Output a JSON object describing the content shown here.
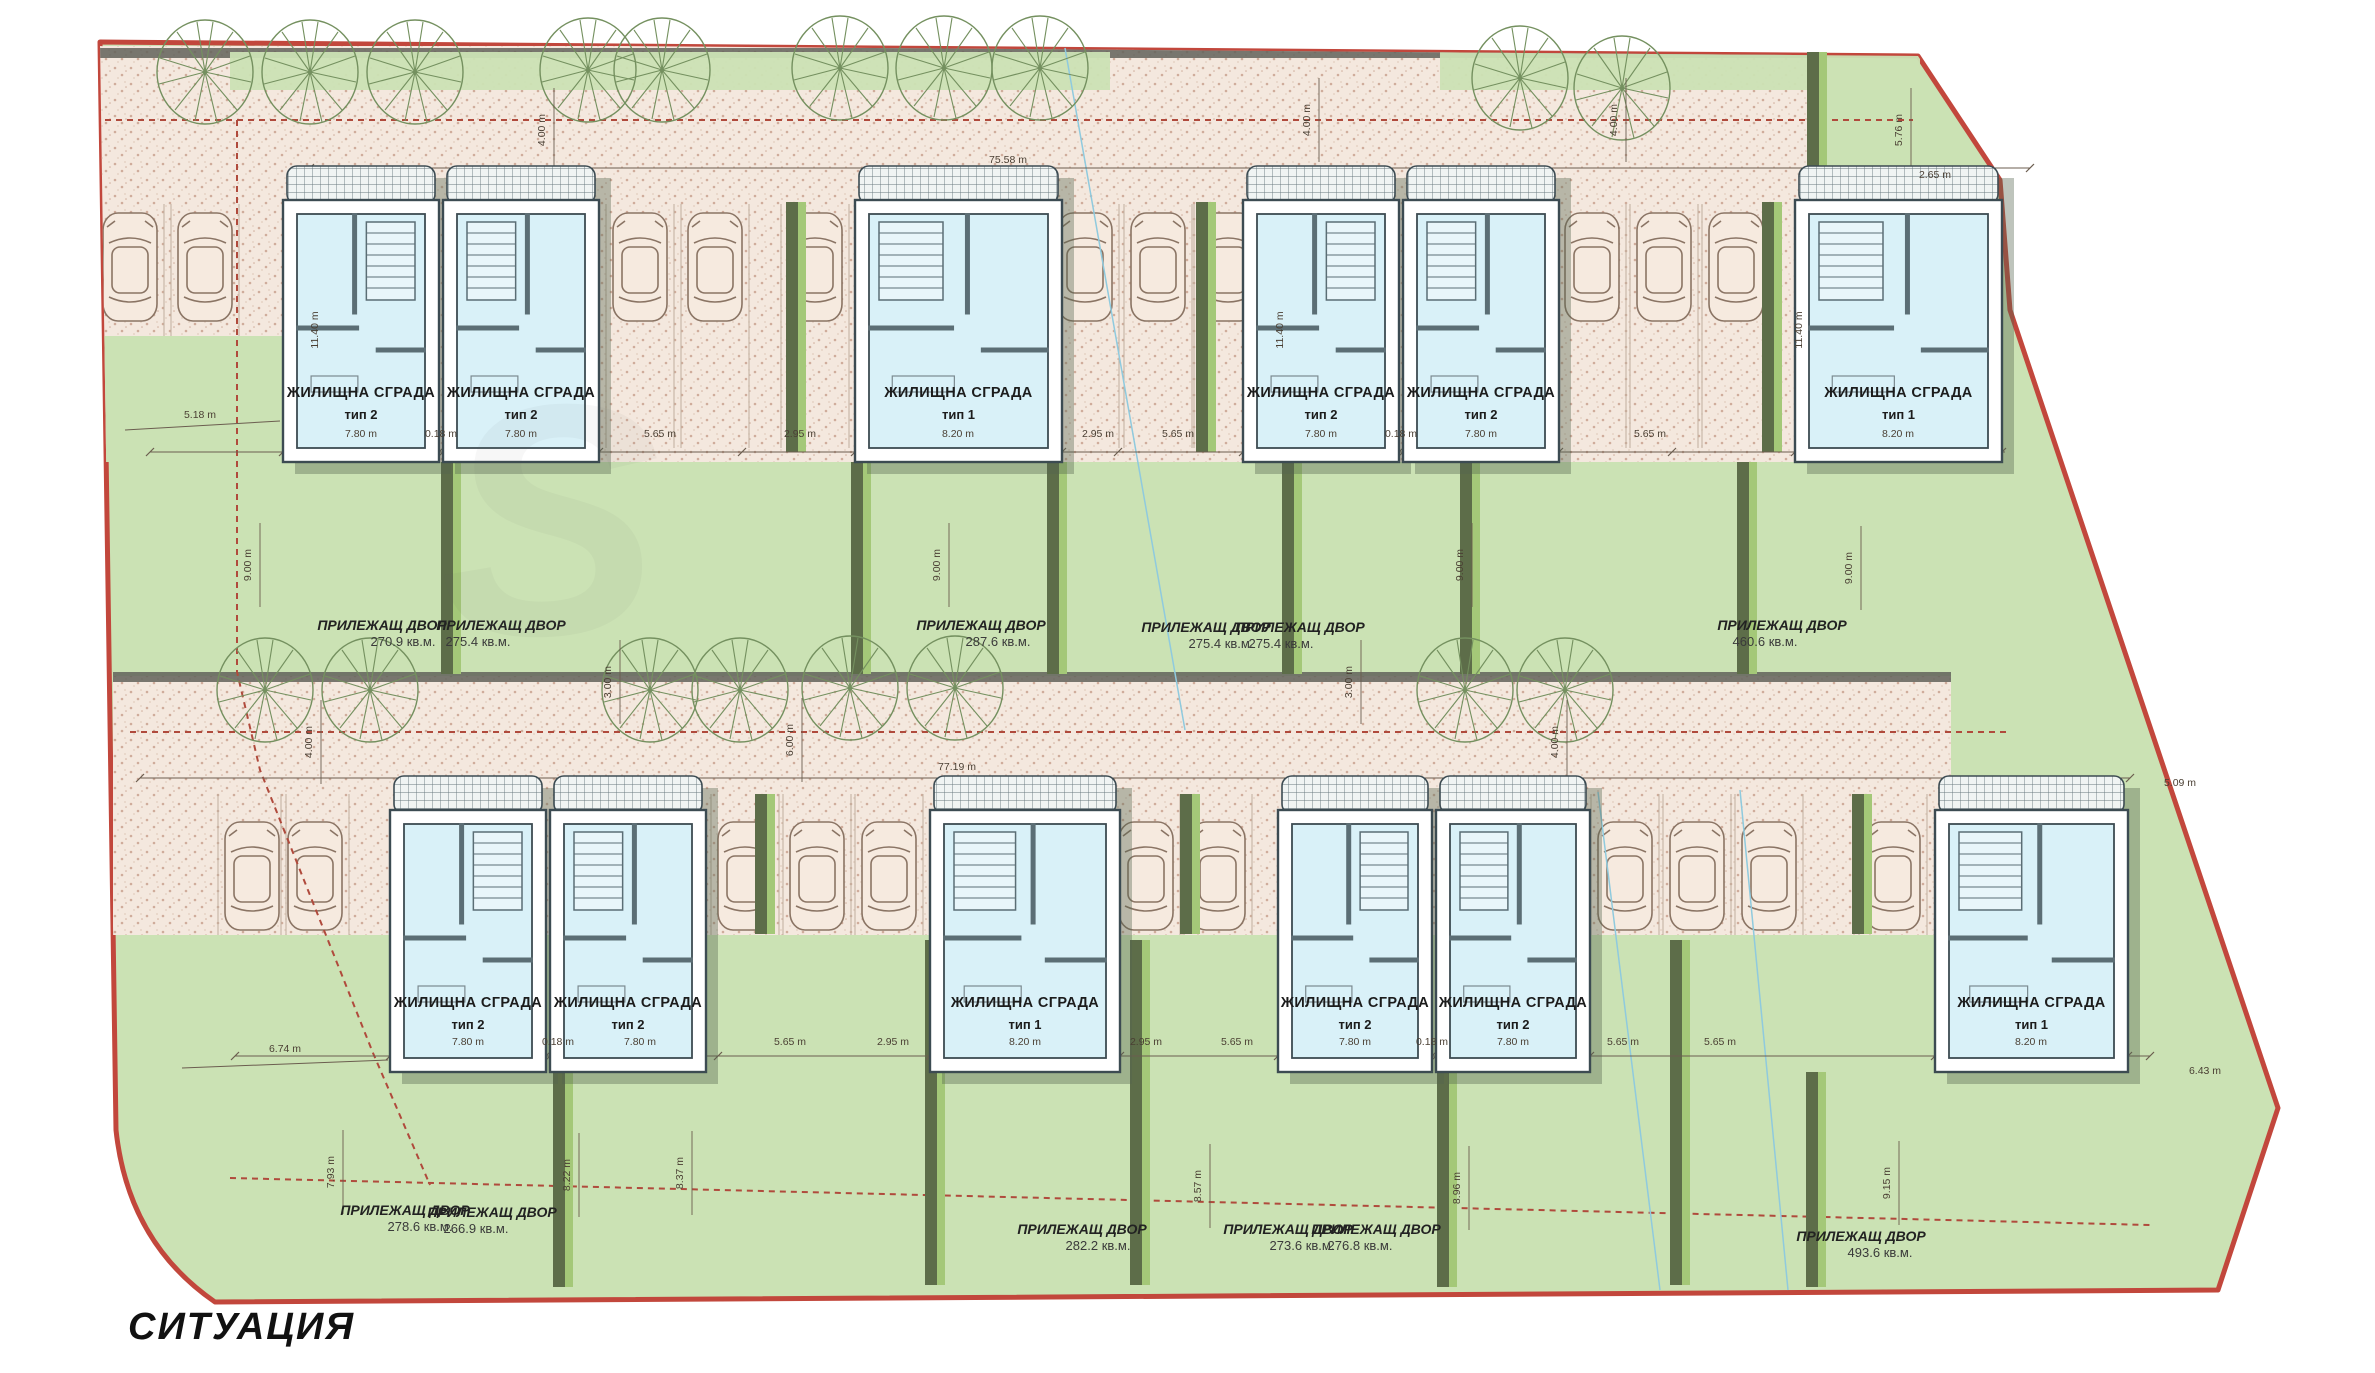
{
  "title": "СИТУАЦИЯ",
  "watermark": "S",
  "colors": {
    "boundary": "#c2473c",
    "parcel_dash": "#b04a3c",
    "site_green": "#cbe2b4",
    "road_pink": "#f4e8de",
    "road_dot": "#c9a28f",
    "curb": "#62625a",
    "fence_dark": "#5d6d49",
    "fence_light": "#a4c878",
    "wall_outline": "#3c4b52",
    "wall_fill": "#ffffff",
    "interior": "#d9f1f8",
    "interior_wall": "#5b6e75",
    "shadow": "#55654f",
    "tree": "#74905f",
    "car": "#8a7464",
    "dim": "#4a3f33",
    "terrace_bg": "#f0f4f3",
    "terrace_line": "#68787e",
    "utility_blue": "#8fcade"
  },
  "buildings": [
    {
      "name": "ЖИЛИЩНА СГРАДА",
      "type": "тип 2",
      "row": "top",
      "x": 283,
      "w": 156,
      "stair": "right"
    },
    {
      "name": "ЖИЛИЩНА СГРАДА",
      "type": "тип 2",
      "row": "top",
      "x": 443,
      "w": 156,
      "stair": "left"
    },
    {
      "name": "ЖИЛИЩНА СГРАДА",
      "type": "тип 1",
      "row": "top",
      "x": 855,
      "w": 207,
      "stair": "left"
    },
    {
      "name": "ЖИЛИЩНА СГРАДА",
      "type": "тип 2",
      "row": "top",
      "x": 1243,
      "w": 156,
      "stair": "right"
    },
    {
      "name": "ЖИЛИЩНА СГРАДА",
      "type": "тип 2",
      "row": "top",
      "x": 1403,
      "w": 156,
      "stair": "left"
    },
    {
      "name": "ЖИЛИЩНА СГРАДА",
      "type": "тип 1",
      "row": "top",
      "x": 1795,
      "w": 207,
      "stair": "left"
    },
    {
      "name": "ЖИЛИЩНА СГРАДА",
      "type": "тип 2",
      "row": "bottom",
      "x": 390,
      "w": 156,
      "stair": "right"
    },
    {
      "name": "ЖИЛИЩНА СГРАДА",
      "type": "тип 2",
      "row": "bottom",
      "x": 550,
      "w": 156,
      "stair": "left"
    },
    {
      "name": "ЖИЛИЩНА СГРАДА",
      "type": "тип 1",
      "row": "bottom",
      "x": 930,
      "w": 190,
      "stair": "left"
    },
    {
      "name": "ЖИЛИЩНА СГРАДА",
      "type": "тип 2",
      "row": "bottom",
      "x": 1278,
      "w": 154,
      "stair": "right"
    },
    {
      "name": "ЖИЛИЩНА СГРАДА",
      "type": "тип 2",
      "row": "bottom",
      "x": 1436,
      "w": 154,
      "stair": "left"
    },
    {
      "name": "ЖИЛИЩНА СГРАДА",
      "type": "тип 1",
      "row": "bottom",
      "x": 1935,
      "w": 193,
      "stair": "left"
    }
  ],
  "yards": [
    {
      "name": "ПРИЛЕЖАЩ ДВОР",
      "area": "270.9 кв.м.",
      "nx": 382,
      "ny": 630,
      "ax": 403,
      "ay": 646
    },
    {
      "name": "ПРИЛЕЖАЩ ДВОР",
      "area": "275.4 кв.м.",
      "nx": 501,
      "ny": 630,
      "ax": 478,
      "ay": 646
    },
    {
      "name": "ПРИЛЕЖАЩ ДВОР",
      "area": "287.6 кв.м.",
      "nx": 981,
      "ny": 630,
      "ax": 998,
      "ay": 646
    },
    {
      "name": "ПРИЛЕЖАЩ ДВОР",
      "area": "275.4 кв.м.",
      "nx": 1206,
      "ny": 632,
      "ax": 1221,
      "ay": 648
    },
    {
      "name": "ПРИЛЕЖАЩ ДВОР",
      "area": "275.4 кв.м.",
      "nx": 1300,
      "ny": 632,
      "ax": 1281,
      "ay": 648
    },
    {
      "name": "ПРИЛЕЖАЩ ДВОР",
      "area": "460.6 кв.м.",
      "nx": 1782,
      "ny": 630,
      "ax": 1765,
      "ay": 646
    },
    {
      "name": "ПРИЛЕЖАЩ ДВОР",
      "area": "278.6 кв.м.",
      "nx": 405,
      "ny": 1215,
      "ax": 420,
      "ay": 1231
    },
    {
      "name": "ПРИЛЕЖАЩ ДВОР",
      "area": "266.9 кв.м.",
      "nx": 492,
      "ny": 1217,
      "ax": 476,
      "ay": 1233
    },
    {
      "name": "ПРИЛЕЖАЩ ДВОР",
      "area": "282.2 кв.м.",
      "nx": 1082,
      "ny": 1234,
      "ax": 1098,
      "ay": 1250
    },
    {
      "name": "ПРИЛЕЖАЩ ДВОР",
      "area": "273.6 кв.м.",
      "nx": 1288,
      "ny": 1234,
      "ax": 1302,
      "ay": 1250
    },
    {
      "name": "ПРИЛЕЖАЩ ДВОР",
      "area": "276.8 кв.м.",
      "nx": 1376,
      "ny": 1234,
      "ax": 1360,
      "ay": 1250
    },
    {
      "name": "ПРИЛЕЖАЩ ДВОР",
      "area": "493.6 кв.м.",
      "nx": 1861,
      "ny": 1241,
      "ax": 1880,
      "ay": 1257
    }
  ],
  "dimensions": [
    {
      "t": "75.58 m",
      "x": 1008,
      "y": 163,
      "r": 0
    },
    {
      "t": "77.19 m",
      "x": 957,
      "y": 770,
      "r": 0
    },
    {
      "t": "4.00 m",
      "x": 545,
      "y": 130,
      "r": -90
    },
    {
      "t": "4.00 m",
      "x": 1310,
      "y": 120,
      "r": -90
    },
    {
      "t": "4.00 m",
      "x": 1617,
      "y": 120,
      "r": -90
    },
    {
      "t": "5.76 m",
      "x": 1902,
      "y": 130,
      "r": -90
    },
    {
      "t": "2.65 m",
      "x": 1935,
      "y": 178,
      "r": 0
    },
    {
      "t": "5.18 m",
      "x": 200,
      "y": 418,
      "r": 0
    },
    {
      "t": "7.80 m",
      "x": 361,
      "y": 437,
      "r": 0
    },
    {
      "t": "0.18 m",
      "x": 441,
      "y": 437,
      "r": 0
    },
    {
      "t": "7.80 m",
      "x": 521,
      "y": 437,
      "r": 0
    },
    {
      "t": "5.65 m",
      "x": 660,
      "y": 437,
      "r": 0
    },
    {
      "t": "2.95 m",
      "x": 800,
      "y": 437,
      "r": 0
    },
    {
      "t": "8.20 m",
      "x": 958,
      "y": 437,
      "r": 0
    },
    {
      "t": "2.95 m",
      "x": 1098,
      "y": 437,
      "r": 0
    },
    {
      "t": "5.65 m",
      "x": 1178,
      "y": 437,
      "r": 0
    },
    {
      "t": "7.80 m",
      "x": 1321,
      "y": 437,
      "r": 0
    },
    {
      "t": "0.18 m",
      "x": 1401,
      "y": 437,
      "r": 0
    },
    {
      "t": "7.80 m",
      "x": 1481,
      "y": 437,
      "r": 0
    },
    {
      "t": "5.65 m",
      "x": 1650,
      "y": 437,
      "r": 0
    },
    {
      "t": "8.20 m",
      "x": 1898,
      "y": 437,
      "r": 0
    },
    {
      "t": "9.00 m",
      "x": 251,
      "y": 565,
      "r": -90
    },
    {
      "t": "9.00 m",
      "x": 940,
      "y": 565,
      "r": -90
    },
    {
      "t": "9.00 m",
      "x": 1463,
      "y": 565,
      "r": -90
    },
    {
      "t": "9.00 m",
      "x": 1852,
      "y": 568,
      "r": -90
    },
    {
      "t": "11.40 m",
      "x": 318,
      "y": 330,
      "r": -90
    },
    {
      "t": "11.40 m",
      "x": 1283,
      "y": 330,
      "r": -90
    },
    {
      "t": "11.40 m",
      "x": 1802,
      "y": 330,
      "r": -90
    },
    {
      "t": "3.00 m",
      "x": 611,
      "y": 682,
      "r": -90
    },
    {
      "t": "3.00 m",
      "x": 1352,
      "y": 682,
      "r": -90
    },
    {
      "t": "4.00 m",
      "x": 312,
      "y": 742,
      "r": -90
    },
    {
      "t": "6.00 m",
      "x": 793,
      "y": 740,
      "r": -90
    },
    {
      "t": "4.00 m",
      "x": 1558,
      "y": 742,
      "r": -90
    },
    {
      "t": "6.74 m",
      "x": 285,
      "y": 1052,
      "r": 0
    },
    {
      "t": "7.80 m",
      "x": 468,
      "y": 1045,
      "r": 0
    },
    {
      "t": "0.18 m",
      "x": 558,
      "y": 1045,
      "r": 0
    },
    {
      "t": "7.80 m",
      "x": 640,
      "y": 1045,
      "r": 0
    },
    {
      "t": "5.65 m",
      "x": 790,
      "y": 1045,
      "r": 0
    },
    {
      "t": "2.95 m",
      "x": 893,
      "y": 1045,
      "r": 0
    },
    {
      "t": "8.20 m",
      "x": 1025,
      "y": 1045,
      "r": 0
    },
    {
      "t": "2.95 m",
      "x": 1146,
      "y": 1045,
      "r": 0
    },
    {
      "t": "5.65 m",
      "x": 1237,
      "y": 1045,
      "r": 0
    },
    {
      "t": "7.80 m",
      "x": 1355,
      "y": 1045,
      "r": 0
    },
    {
      "t": "0.18 m",
      "x": 1432,
      "y": 1045,
      "r": 0
    },
    {
      "t": "7.80 m",
      "x": 1513,
      "y": 1045,
      "r": 0
    },
    {
      "t": "5.65 m",
      "x": 1623,
      "y": 1045,
      "r": 0
    },
    {
      "t": "5.65 m",
      "x": 1720,
      "y": 1045,
      "r": 0
    },
    {
      "t": "8.20 m",
      "x": 2031,
      "y": 1045,
      "r": 0
    },
    {
      "t": "5.09 m",
      "x": 2180,
      "y": 786,
      "r": 0
    },
    {
      "t": "6.43 m",
      "x": 2205,
      "y": 1074,
      "r": 0
    },
    {
      "t": "7.93 m",
      "x": 334,
      "y": 1172,
      "r": -90
    },
    {
      "t": "8.22 m",
      "x": 570,
      "y": 1175,
      "r": -90
    },
    {
      "t": "8.37 m",
      "x": 683,
      "y": 1173,
      "r": -90
    },
    {
      "t": "8.57 m",
      "x": 1201,
      "y": 1186,
      "r": -90
    },
    {
      "t": "8.96 m",
      "x": 1460,
      "y": 1188,
      "r": -90
    },
    {
      "t": "9.15 m",
      "x": 1890,
      "y": 1183,
      "r": -90
    }
  ],
  "trees": {
    "top": [
      [
        205,
        72
      ],
      [
        310,
        72
      ],
      [
        415,
        72
      ],
      [
        588,
        70
      ],
      [
        662,
        70
      ],
      [
        840,
        68
      ],
      [
        944,
        68
      ],
      [
        1040,
        68
      ],
      [
        1520,
        78
      ],
      [
        1622,
        88
      ]
    ],
    "middle": [
      [
        265,
        690
      ],
      [
        370,
        690
      ],
      [
        650,
        690
      ],
      [
        740,
        690
      ],
      [
        850,
        688
      ],
      [
        955,
        688
      ],
      [
        1465,
        690
      ],
      [
        1565,
        690
      ]
    ]
  },
  "cars": {
    "top": [
      130,
      205,
      640,
      715,
      815,
      1085,
      1158,
      1228,
      1592,
      1664,
      1736
    ],
    "bottom": [
      252,
      315,
      745,
      817,
      889,
      1146,
      1218,
      1625,
      1697,
      1769,
      1893
    ]
  }
}
